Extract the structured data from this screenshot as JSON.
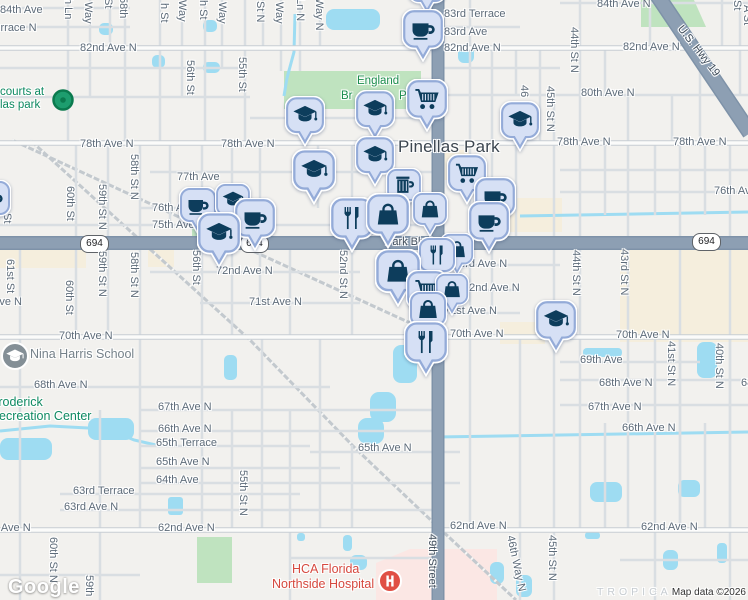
{
  "map": {
    "city_label": "Pinellas Park",
    "logo": "Google",
    "attribution": "Map data ©2026",
    "shield_text": "694",
    "shields": [
      {
        "x": 80,
        "y": 235
      },
      {
        "x": 240,
        "y": 235
      },
      {
        "x": 692,
        "y": 233
      }
    ],
    "street_labels": [
      {
        "t": "84th Ave",
        "x": 0,
        "y": 4
      },
      {
        "t": "83rd Terrace N",
        "x": -36,
        "y": 22
      },
      {
        "t": "84th Ave N",
        "x": 597,
        "y": -2
      },
      {
        "t": "83rd Terrace",
        "x": 444,
        "y": 8
      },
      {
        "t": "83rd Ave",
        "x": 444,
        "y": 26
      },
      {
        "t": "82nd Ave N",
        "x": 80,
        "y": 42
      },
      {
        "t": "82nd Ave N",
        "x": 444,
        "y": 42
      },
      {
        "t": "82nd Ave N",
        "x": 623,
        "y": 41
      },
      {
        "t": "80th Ave N",
        "x": 581,
        "y": 87
      },
      {
        "t": "78th Ave N",
        "x": 80,
        "y": 138
      },
      {
        "t": "78th Ave N",
        "x": 221,
        "y": 138
      },
      {
        "t": "78th Ave N",
        "x": 557,
        "y": 136
      },
      {
        "t": "78th Ave N",
        "x": 673,
        "y": 136
      },
      {
        "t": "77th Ave",
        "x": 177,
        "y": 171
      },
      {
        "t": "76th Ave N",
        "x": 152,
        "y": 202
      },
      {
        "t": "75th Ave N",
        "x": 152,
        "y": 219
      },
      {
        "t": "76th Ave N",
        "x": 714,
        "y": 185
      },
      {
        "t": "73rd Ave N",
        "x": 453,
        "y": 258
      },
      {
        "t": "72nd Ave N",
        "x": 216,
        "y": 265
      },
      {
        "t": "72nd Ave N",
        "x": 463,
        "y": 282
      },
      {
        "t": "71st Ave N",
        "x": -31,
        "y": 296
      },
      {
        "t": "71st Ave N",
        "x": 249,
        "y": 296
      },
      {
        "t": "71st Ave N",
        "x": 444,
        "y": 305
      },
      {
        "t": "70th Ave N",
        "x": 59,
        "y": 330
      },
      {
        "t": "70th Ave N",
        "x": 450,
        "y": 328
      },
      {
        "t": "70th Ave N",
        "x": 616,
        "y": 329
      },
      {
        "t": "69th Ave",
        "x": 580,
        "y": 354
      },
      {
        "t": "68th Ave N",
        "x": 34,
        "y": 379
      },
      {
        "t": "68th Ave N",
        "x": 599,
        "y": 377
      },
      {
        "t": "68th Ave N",
        "x": 741,
        "y": 377
      },
      {
        "t": "67th Ave N",
        "x": 158,
        "y": 401
      },
      {
        "t": "67th Ave N",
        "x": 588,
        "y": 401
      },
      {
        "t": "66th Ave N",
        "x": 158,
        "y": 423
      },
      {
        "t": "66th Ave N",
        "x": 622,
        "y": 422
      },
      {
        "t": "65th Terrace",
        "x": 156,
        "y": 437
      },
      {
        "t": "65th Ave N",
        "x": 156,
        "y": 456
      },
      {
        "t": "65th Ave N",
        "x": 358,
        "y": 442
      },
      {
        "t": "64th Ave",
        "x": 156,
        "y": 474
      },
      {
        "t": "63rd Terrace",
        "x": 73,
        "y": 485
      },
      {
        "t": "63rd Ave N",
        "x": 64,
        "y": 501
      },
      {
        "t": "62nd Ave N",
        "x": -26,
        "y": 522
      },
      {
        "t": "62nd Ave N",
        "x": 158,
        "y": 522
      },
      {
        "t": "62nd Ave N",
        "x": 450,
        "y": 520
      },
      {
        "t": "62nd Ave N",
        "x": 641,
        "y": 521
      },
      {
        "t": "h Ln",
        "x": 62,
        "y": -2,
        "v": 1
      },
      {
        "t": "Way",
        "x": 82,
        "y": 2,
        "v": 1
      },
      {
        "t": "St",
        "x": 102,
        "y": -2,
        "v": 1
      },
      {
        "t": "58th",
        "x": 117,
        "y": -3,
        "v": 1
      },
      {
        "t": "h St",
        "x": 158,
        "y": 3,
        "v": 1
      },
      {
        "t": "Way",
        "x": 176,
        "y": 0,
        "v": 1
      },
      {
        "t": "h St",
        "x": 197,
        "y": 0,
        "v": 1
      },
      {
        "t": "Way",
        "x": 216,
        "y": 2,
        "v": 1
      },
      {
        "t": "St N",
        "x": 254,
        "y": 1,
        "v": 1
      },
      {
        "t": "Way",
        "x": 273,
        "y": 2,
        "v": 1
      },
      {
        "t": "Ln N",
        "x": 294,
        "y": -2,
        "v": 1
      },
      {
        "t": "Way N",
        "x": 313,
        "y": -2,
        "v": 1
      },
      {
        "t": "St",
        "x": 731,
        "y": 0,
        "v": 1
      },
      {
        "t": "A St",
        "x": 741,
        "y": 5,
        "v": 1
      },
      {
        "t": "56th St",
        "x": 184,
        "y": 60,
        "v": 1
      },
      {
        "t": "55th St",
        "x": 236,
        "y": 57,
        "v": 1
      },
      {
        "t": "46",
        "x": 518,
        "y": 85,
        "v": 1
      },
      {
        "t": "45th St N",
        "x": 544,
        "y": 86,
        "v": 1
      },
      {
        "t": "44th St N",
        "x": 568,
        "y": 27,
        "v": 1
      },
      {
        "t": "60th St",
        "x": 64,
        "y": 186,
        "v": 1
      },
      {
        "t": "59th St N",
        "x": 96,
        "y": 184,
        "v": 1
      },
      {
        "t": "58th St N",
        "x": 128,
        "y": 154,
        "v": 1
      },
      {
        "t": "St",
        "x": 1,
        "y": 213,
        "v": 1
      },
      {
        "t": "61st St",
        "x": 4,
        "y": 259,
        "v": 1
      },
      {
        "t": "60th St",
        "x": 63,
        "y": 280,
        "v": 1
      },
      {
        "t": "59th St N",
        "x": 96,
        "y": 251,
        "v": 1
      },
      {
        "t": "58th St N",
        "x": 128,
        "y": 252,
        "v": 1
      },
      {
        "t": "56th St",
        "x": 190,
        "y": 250,
        "v": 1
      },
      {
        "t": "52nd St N",
        "x": 337,
        "y": 250,
        "v": 1
      },
      {
        "t": "44th St N",
        "x": 570,
        "y": 250,
        "v": 1
      },
      {
        "t": "43rd St N",
        "x": 618,
        "y": 249,
        "v": 1
      },
      {
        "t": "41st St N",
        "x": 665,
        "y": 341,
        "v": 1
      },
      {
        "t": "40th St N",
        "x": 713,
        "y": 343,
        "v": 1
      },
      {
        "t": "55th St N",
        "x": 237,
        "y": 470,
        "v": 1
      },
      {
        "t": "60th St N",
        "x": 47,
        "y": 537,
        "v": 1
      },
      {
        "t": "59th",
        "x": 83,
        "y": 575,
        "v": 1
      },
      {
        "t": "46th Way N",
        "x": 510,
        "y": 535,
        "v": 1,
        "r": -12
      },
      {
        "t": "45th St N",
        "x": 546,
        "y": 535,
        "v": 1
      }
    ],
    "poi_labels": [
      {
        "t": "Pinellas Park",
        "cls": "city",
        "x": 398,
        "y": 137,
        "n": "city-label",
        "it": true
      },
      {
        "t": "England",
        "cls": "park",
        "x": 357,
        "y": 75,
        "n": "park-label-england-brothers",
        "it": true
      },
      {
        "t": "Br",
        "cls": "park",
        "x": 341,
        "y": 90,
        "n": "park-label-fragment",
        "it": true
      },
      {
        "t": "P",
        "cls": "park",
        "x": 399,
        "y": 90,
        "n": "park-label-fragment",
        "it": true
      },
      {
        "t": "courts at",
        "cls": "poi-green",
        "x": 0,
        "y": 86,
        "n": "poi-label-courts",
        "it": true
      },
      {
        "t": "las park",
        "cls": "poi-green",
        "x": 0,
        "y": 99,
        "n": "poi-label-courts",
        "it": true
      },
      {
        "t": "Nina Harris School",
        "cls": "poi-gray",
        "x": 30,
        "y": 347,
        "n": "poi-label-nina-harris-school",
        "it": true
      },
      {
        "t": "Broderick",
        "cls": "poi-teal",
        "x": -10,
        "y": 395,
        "n": "poi-label-recreation-center",
        "it": true
      },
      {
        "t": "Recreation Center",
        "cls": "poi-teal",
        "x": -10,
        "y": 409,
        "n": "poi-label-recreation-center",
        "it": true
      },
      {
        "t": "HCA Florida",
        "cls": "hospital",
        "x": 292,
        "y": 562,
        "n": "poi-label-hospital",
        "it": true
      },
      {
        "t": "Northside Hospital",
        "cls": "hospital",
        "x": 272,
        "y": 577,
        "n": "poi-label-hospital",
        "it": true
      },
      {
        "t": "Park Blvd",
        "cls": "road-label",
        "x": 385,
        "y": 236,
        "n": "road-label-park-blvd",
        "it": false
      },
      {
        "t": "49th Street",
        "cls": "road-label",
        "x": 426,
        "y": 534,
        "v": 1,
        "n": "road-label-49th-street",
        "it": false
      },
      {
        "t": "U.S. Hwy 19",
        "cls": "road-label",
        "x": 668,
        "y": 45,
        "r": 52,
        "n": "road-label-us-hwy-19",
        "it": false
      },
      {
        "t": "TROPICAL",
        "cls": "ghost",
        "x": 597,
        "y": 586,
        "n": "neighborhood-label",
        "it": false
      }
    ],
    "pins": [
      {
        "i": "shopping-cart",
        "x": 427,
        "y": -14,
        "s": 38
      },
      {
        "i": "coffee",
        "x": 423,
        "y": 30,
        "s": 42
      },
      {
        "i": "graduation-cap",
        "x": 305,
        "y": 116,
        "s": 40
      },
      {
        "i": "graduation-cap",
        "x": 375,
        "y": 110,
        "s": 40
      },
      {
        "i": "shopping-cart",
        "x": 427,
        "y": 100,
        "s": 42
      },
      {
        "i": "graduation-cap",
        "x": 520,
        "y": 121,
        "s": 40
      },
      {
        "i": "coffee",
        "x": 198,
        "y": 206,
        "s": 38
      },
      {
        "i": "graduation-cap",
        "x": 233,
        "y": 201,
        "s": 36
      },
      {
        "i": "coffee",
        "x": 255,
        "y": 219,
        "s": 42
      },
      {
        "i": "graduation-cap",
        "x": 219,
        "y": 234,
        "s": 44
      },
      {
        "i": "coffee",
        "x": -8,
        "y": 199,
        "s": 38
      },
      {
        "i": "graduation-cap",
        "x": 314,
        "y": 171,
        "s": 44
      },
      {
        "i": "graduation-cap",
        "x": 375,
        "y": 156,
        "s": 40
      },
      {
        "i": "beer-mug",
        "x": 404,
        "y": 186,
        "s": 36
      },
      {
        "i": "shopping-bag",
        "x": 430,
        "y": 210,
        "s": 36
      },
      {
        "i": "shopping-cart",
        "x": 467,
        "y": 174,
        "s": 40
      },
      {
        "i": "coffee",
        "x": 495,
        "y": 198,
        "s": 42
      },
      {
        "i": "coffee",
        "x": 489,
        "y": 222,
        "s": 42
      },
      {
        "i": "restaurant",
        "x": 352,
        "y": 219,
        "s": 44
      },
      {
        "i": "shopping-bag",
        "x": 388,
        "y": 215,
        "s": 44
      },
      {
        "i": "shopping-bag",
        "x": 457,
        "y": 250,
        "s": 34
      },
      {
        "i": "restaurant",
        "x": 437,
        "y": 256,
        "s": 38
      },
      {
        "i": "shopping-bag",
        "x": 398,
        "y": 272,
        "s": 46
      },
      {
        "i": "shopping-cart",
        "x": 427,
        "y": 291,
        "s": 42
      },
      {
        "i": "shopping-bag",
        "x": 452,
        "y": 290,
        "s": 34
      },
      {
        "i": "shopping-bag",
        "x": 428,
        "y": 310,
        "s": 38
      },
      {
        "i": "restaurant",
        "x": 426,
        "y": 343,
        "s": 44
      },
      {
        "i": "graduation-cap",
        "x": 556,
        "y": 321,
        "s": 42
      }
    ],
    "markers": [
      {
        "k": "park-dot",
        "x": 63,
        "y": 100
      },
      {
        "k": "school",
        "x": 15,
        "y": 356
      },
      {
        "k": "hospital",
        "x": 390,
        "y": 581
      }
    ],
    "colors": {
      "major_road": "#8d9fb3",
      "water": "#9edcf2",
      "park_green": "#bfe3bf",
      "commercial_beige": "#f5eedd",
      "hospital_pink": "#fbe7e4",
      "pin_fill": "#d6e0f5",
      "pin_border": "#94abd8",
      "pin_icon": "#0d3d5c",
      "hospital_red": "#e04f44",
      "poi_green": "#1d9d6e"
    }
  }
}
